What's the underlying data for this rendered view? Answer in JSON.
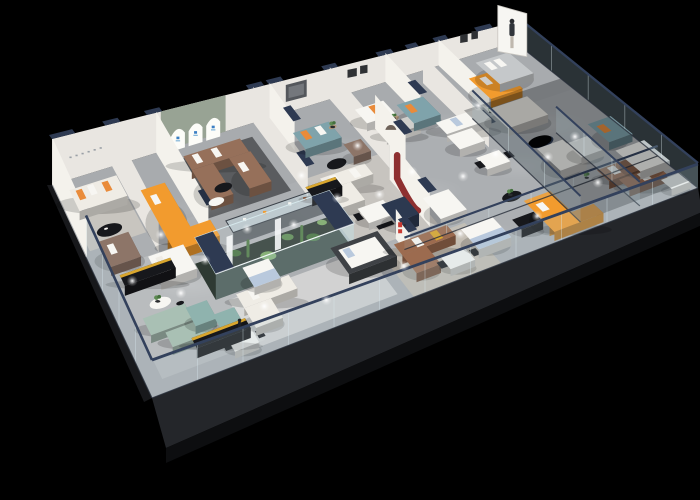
{
  "meta": {
    "title": "3D isometric cutaway render of a furniture showroom floor plan",
    "canvas": {
      "width": 700,
      "height": 500
    },
    "background": "black",
    "visible_text": "none-legible (tiny wall signage and logos only)"
  },
  "palette": {
    "bg": "#000000",
    "floor": "#a8abae",
    "floorHi": "#c2c5c6",
    "slab": "#24262a",
    "slabSide": "#0d0e10",
    "wall": "#e9e6e1",
    "wallLit": "#f4f2ec",
    "wallShade": "#d8d4cd",
    "cap": "#2e3a52",
    "rail": "#33415c",
    "glass": "rgba(172,196,206,0.22)",
    "glassDark": "rgba(105,126,136,0.40)",
    "glassCase": "rgba(205,228,234,0.40)",
    "sage": "#98a394",
    "arch": "#fcfcf8",
    "blue": "#3b7fc4",
    "orange": "#f29b2e",
    "orangeDk": "#d97f16",
    "orangePillow": "#e98b3a",
    "brown": "#96705a",
    "leather": "#9c6b4f",
    "taupe": "#8d7568",
    "teal": "#7fa3ab",
    "sageSofa": "#a9c0b4",
    "mint": "#8fb3ae",
    "cream": "#efece5",
    "white": "#f7f6f2",
    "black": "#17181c",
    "gold": "#d9a62e",
    "navy": "#2c3950",
    "redRibbon": "#8e3030",
    "redLogo": "#c93a32",
    "bedBlue": "#b9c9dd",
    "greyBed": "#c5c8ca",
    "frameDark": "#3f4246",
    "wood": "#b2977a",
    "plant": "#5d8a52",
    "plantDk": "#44703c",
    "rugDark": "#55575b",
    "rugLight": "#cbc8c1",
    "rugTan": "#c9c0b2",
    "rugGrey": "#bfc2c3",
    "dim": "rgba(6,9,13,0.30)",
    "spot": "#ffffff"
  },
  "scene": {
    "type": "isometric-floorplan-render",
    "items": [
      {
        "id": "floor-slab",
        "kind": "structure",
        "color": "slab"
      },
      {
        "id": "floor",
        "kind": "structure",
        "color": "floor"
      },
      {
        "id": "corner-rug",
        "kind": "rug",
        "color": "rugLight"
      },
      {
        "id": "arch-rug",
        "kind": "rug",
        "color": "rugDark"
      },
      {
        "id": "mid-rug",
        "kind": "rug",
        "color": "rugLight"
      },
      {
        "id": "front-left-rug",
        "kind": "rug",
        "color": "rugGrey"
      },
      {
        "id": "bedroom-rug",
        "kind": "rug",
        "color": "white"
      },
      {
        "id": "leather-rug",
        "kind": "rug",
        "color": "rugTan"
      },
      {
        "id": "light-pools",
        "kind": "lighting",
        "color": "spot"
      },
      {
        "id": "back-wall",
        "kind": "wall",
        "color": "wall"
      },
      {
        "id": "left-wall",
        "kind": "wall",
        "color": "wallLit"
      },
      {
        "id": "partition-a",
        "kind": "wall",
        "color": "wall"
      },
      {
        "id": "partition-b",
        "kind": "wall",
        "color": "wallLit"
      },
      {
        "id": "partition-c",
        "kind": "wall",
        "color": "wall"
      },
      {
        "id": "partition-d",
        "kind": "wall",
        "color": "wallLit"
      },
      {
        "id": "partition-e",
        "kind": "wall",
        "color": "wall"
      },
      {
        "id": "partition-f",
        "kind": "wall",
        "color": "wallLit"
      },
      {
        "id": "partition-g",
        "kind": "wall",
        "color": "wall"
      },
      {
        "id": "partition-h",
        "kind": "wall",
        "color": "wallLit"
      },
      {
        "id": "corner-sofa",
        "kind": "sofa",
        "color": "cream",
        "accent": "orangePillow"
      },
      {
        "id": "corner-coffee-table",
        "kind": "table",
        "color": "black"
      },
      {
        "id": "orange-nook-sofa",
        "kind": "sofa",
        "color": "orange"
      },
      {
        "id": "brown-u-sofa",
        "kind": "sofa",
        "color": "brown",
        "accent": "white"
      },
      {
        "id": "arch-coffee-tables",
        "kind": "table",
        "color": "black"
      },
      {
        "id": "tv-teal-sofa",
        "kind": "sofa",
        "color": "teal",
        "accent": "orangePillow"
      },
      {
        "id": "tv-coffee-table",
        "kind": "table",
        "color": "black"
      },
      {
        "id": "tv-plant-table",
        "kind": "decor",
        "color": "plant"
      },
      {
        "id": "loveseat-sofas",
        "kind": "sofa",
        "color": "white"
      },
      {
        "id": "loveseat-side-table",
        "kind": "table",
        "color": "wood"
      },
      {
        "id": "teal-bench",
        "kind": "sofa",
        "color": "teal",
        "accent": "orangePillow"
      },
      {
        "id": "family-sofas",
        "kind": "sofa",
        "color": "white"
      },
      {
        "id": "family-dining-set",
        "kind": "dining",
        "color": "white"
      },
      {
        "id": "reception-orange-sofa",
        "kind": "sofa",
        "color": "orange"
      },
      {
        "id": "reception-sectional",
        "kind": "sofa",
        "color": "cream"
      },
      {
        "id": "reception-ottoman",
        "kind": "ottoman",
        "color": "navy"
      },
      {
        "id": "reception-plant-table",
        "kind": "table",
        "color": "black"
      },
      {
        "id": "rw-grey-bed",
        "kind": "bed",
        "color": "greyBed"
      },
      {
        "id": "rw-white-sofa",
        "kind": "sofa",
        "color": "white"
      },
      {
        "id": "rw-brown-sofas",
        "kind": "sofa",
        "color": "leather",
        "accent": "white"
      },
      {
        "id": "rw-armchair",
        "kind": "chair",
        "color": "white"
      },
      {
        "id": "rw-teal-sofa",
        "kind": "sofa",
        "color": "teal",
        "accent": "orangePillow"
      },
      {
        "id": "rw-white-bed",
        "kind": "bed",
        "color": "white"
      },
      {
        "id": "glass-display-counter",
        "kind": "display",
        "color": "glassCase"
      },
      {
        "id": "mid-sectional",
        "kind": "sofa",
        "color": "cream"
      },
      {
        "id": "mid-dining-set",
        "kind": "dining",
        "color": "white"
      },
      {
        "id": "tan-armchair",
        "kind": "chair",
        "color": "taupe"
      },
      {
        "id": "curved-niche-wall",
        "kind": "wall",
        "color": "wallLit"
      },
      {
        "id": "redj-display-wall",
        "kind": "wall",
        "color": "wallLit",
        "accent": "redRibbon"
      },
      {
        "id": "navy-counter",
        "kind": "counter",
        "color": "navy"
      },
      {
        "id": "media-console-c",
        "kind": "console",
        "color": "black",
        "accent": "gold"
      },
      {
        "id": "terrarium",
        "kind": "display",
        "color": "plant"
      },
      {
        "id": "white-bed",
        "kind": "bed",
        "color": "white"
      },
      {
        "id": "taupe-sofa",
        "kind": "sofa",
        "color": "taupe"
      },
      {
        "id": "media-console-a",
        "kind": "console",
        "color": "black",
        "accent": "gold"
      },
      {
        "id": "sage-sofas",
        "kind": "sofa",
        "color": "sageSofa"
      },
      {
        "id": "flower-table",
        "kind": "table",
        "color": "white"
      },
      {
        "id": "mint-chaises",
        "kind": "chair",
        "color": "mint"
      },
      {
        "id": "front-dining-set",
        "kind": "dining",
        "color": "white"
      },
      {
        "id": "media-console-b",
        "kind": "console",
        "color": "black",
        "accent": "gold"
      },
      {
        "id": "shopper-figure",
        "kind": "person",
        "color": "black"
      },
      {
        "id": "tf-white-sectional",
        "kind": "sofa",
        "color": "cream"
      },
      {
        "id": "blue-bed",
        "kind": "bed",
        "color": "bedBlue"
      },
      {
        "id": "canopy-bed",
        "kind": "bed",
        "color": "frameDark"
      },
      {
        "id": "white-curve-sofa",
        "kind": "sofa",
        "color": "white"
      },
      {
        "id": "red-logo-wall",
        "kind": "signage",
        "color": "wallLit",
        "accent": "redLogo"
      },
      {
        "id": "leather-sofa",
        "kind": "sofa",
        "color": "leather",
        "accent": "white"
      },
      {
        "id": "leather-dining-set",
        "kind": "dining",
        "color": "white"
      },
      {
        "id": "bluegrey-bed",
        "kind": "bed",
        "color": "bedBlue"
      },
      {
        "id": "desk-black",
        "kind": "desk",
        "color": "black"
      },
      {
        "id": "orange-corner-sofa",
        "kind": "sofa",
        "color": "orange"
      },
      {
        "id": "inner-glass-rail",
        "kind": "glass",
        "color": "rail"
      },
      {
        "id": "right-wing-dim",
        "kind": "lighting",
        "color": "dim"
      },
      {
        "id": "right-end-glass",
        "kind": "glass",
        "color": "glassDark"
      },
      {
        "id": "glass-partition-1",
        "kind": "glass",
        "color": "glass"
      },
      {
        "id": "glass-partition-2",
        "kind": "glass",
        "color": "glass"
      },
      {
        "id": "front-glass",
        "kind": "glass",
        "color": "glass"
      },
      {
        "id": "left-glass",
        "kind": "glass",
        "color": "glass"
      },
      {
        "id": "ceiling-spotlights",
        "kind": "lighting",
        "color": "spot"
      },
      {
        "id": "reception-standee",
        "kind": "person",
        "color": "white"
      }
    ],
    "signage": [
      {
        "id": "arch-window-logos",
        "color": "blue",
        "legible": false
      },
      {
        "id": "red-brand-logo",
        "color": "redLogo",
        "legible": false
      },
      {
        "id": "corner-wall-sign",
        "color": "wallShade",
        "legible": false
      }
    ],
    "lighting": {
      "spotlights": 22
    }
  }
}
